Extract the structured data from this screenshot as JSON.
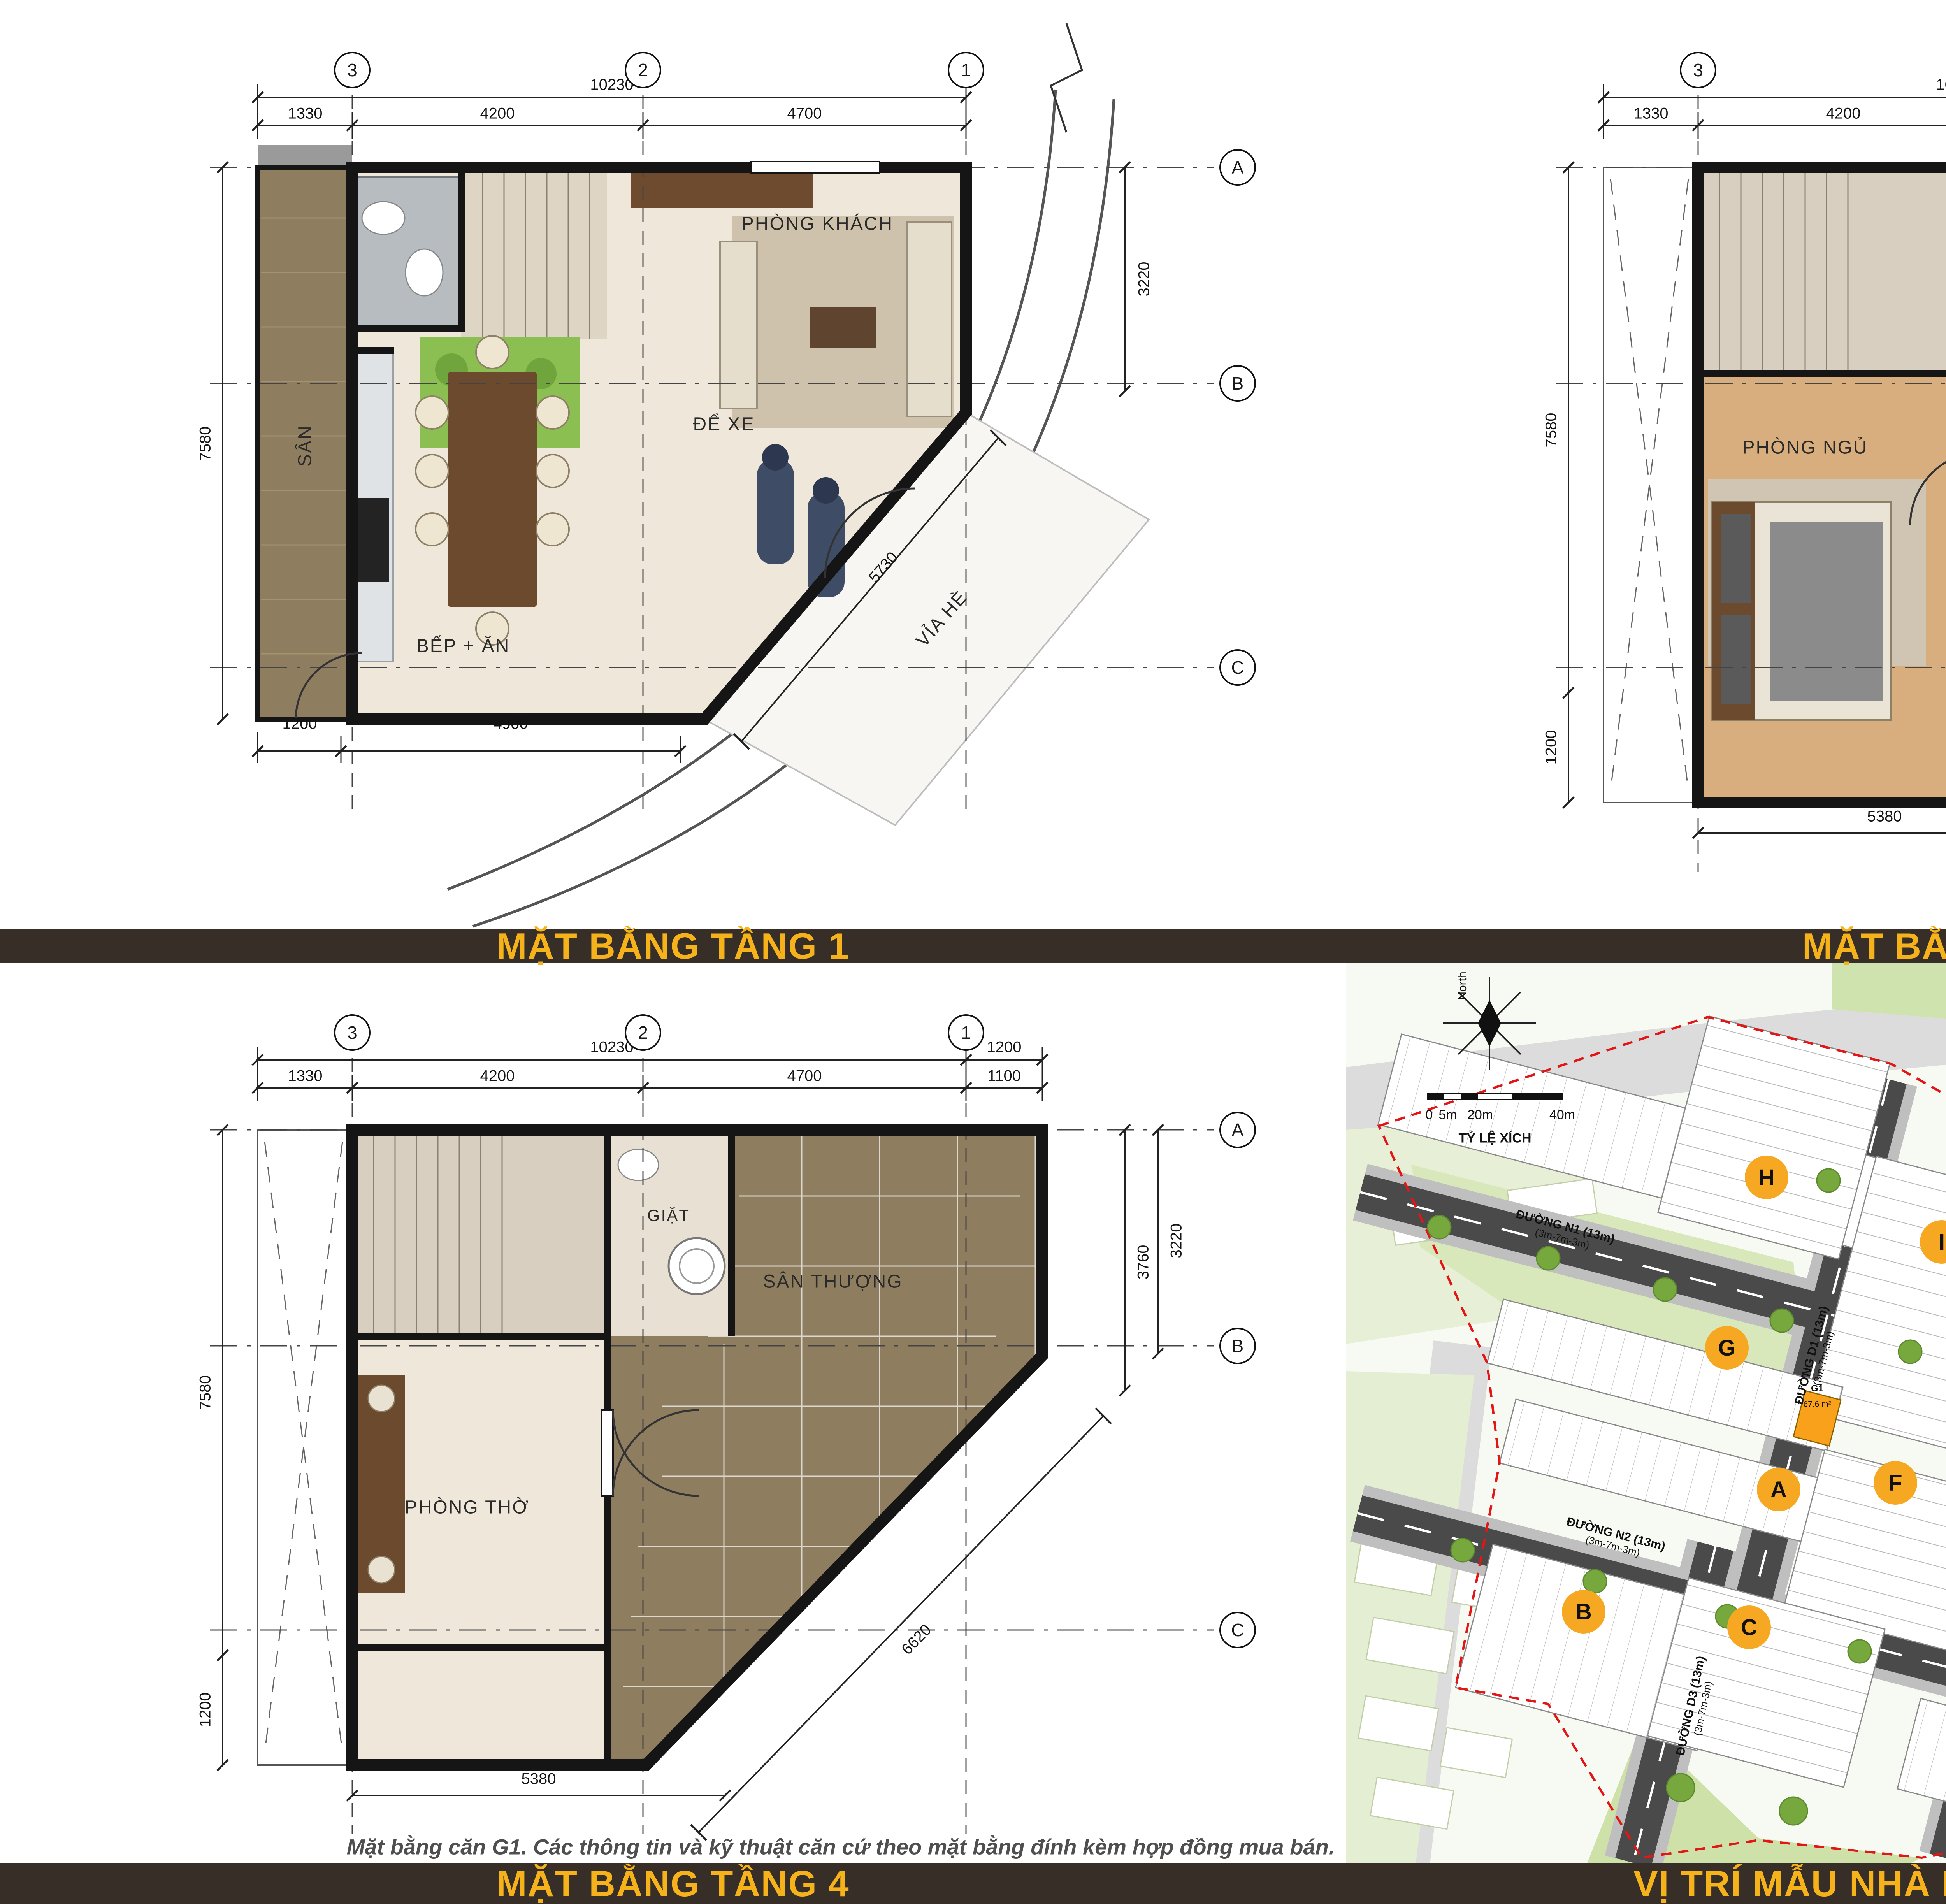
{
  "bars": {
    "floor1": "MẶT BẰNG TẦNG 1",
    "floor23": "MẶT BẰNG TẦNG 2 → 3",
    "floor4": "MẶT BẰNG TẦNG 4",
    "site": "VỊ TRÍ MẪU NHÀ MG2"
  },
  "caption": "Mặt bằng căn G1. Các thông tin và kỹ thuật căn cứ theo mặt bằng đính kèm hợp đồng mua bán.",
  "main_title": {
    "dark": "MẪU NHÀ",
    "accent": "MG2 (G1)"
  },
  "table": {
    "title": "BẢNG THỐNG KÊ CHI TIẾT MẪU NHÀ MG2",
    "headers": [
      {
        "l1": "Lô",
        "l2": ""
      },
      {
        "l1": "Kích thước nhà",
        "l2": "Rộng x Dài (m)"
      },
      {
        "l1": "Diện tích",
        "l2": "Khu đất (m²)"
      },
      {
        "l1": "Diện tích",
        "l2": "Sàn XD (m²)"
      }
    ],
    "row": [
      "G1",
      "10.23 x 7.58",
      "67.6",
      "237.6"
    ]
  },
  "floor1": {
    "grid_cols": [
      "3",
      "2",
      "1"
    ],
    "grid_rows": [
      "A",
      "B",
      "C"
    ],
    "dim_total": "10230",
    "dims_top": [
      "1330",
      "4200",
      "4700"
    ],
    "dim_left": "7580",
    "dim_right": "3220",
    "dims_bottom": [
      "1200",
      "4900"
    ],
    "dim_diag": "5730",
    "room_living": "PHÒNG KHÁCH",
    "room_kitchen": "BẾP + ĂN",
    "room_garage": "ĐỂ XE",
    "room_yard": "SÂN",
    "sidewalk": "VỈA HÈ"
  },
  "floor23": {
    "grid_cols": [
      "3",
      "2",
      "1"
    ],
    "grid_rows": [
      "A",
      "B",
      "C"
    ],
    "dim_total": "10230",
    "dim_top_right": "1200",
    "dims_top": [
      "1330",
      "4200",
      "4700",
      "1100"
    ],
    "dims_right": [
      "3760",
      "3220"
    ],
    "dim_left": "7580",
    "dim_left_bottom": "1200",
    "dim_bottom": "5380",
    "dim_diag": "6620",
    "room_bedroom": "PHÒNG NGỦ",
    "room_wc1": "WC",
    "room_wc2": "WC"
  },
  "floor4": {
    "grid_cols": [
      "3",
      "2",
      "1"
    ],
    "grid_rows": [
      "A",
      "B",
      "C"
    ],
    "dim_total": "10230",
    "dim_top_right": "1200",
    "dims_top": [
      "1330",
      "4200",
      "4700",
      "1100"
    ],
    "dims_right": [
      "3760",
      "3220"
    ],
    "dim_left": "7580",
    "dim_left_bottom": "1200",
    "dim_bottom": "5380",
    "dim_diag": "6620",
    "room_laundry": "GIẶT",
    "room_worship": "PHÒNG THỜ",
    "room_terrace": "SÂN THƯỢNG"
  },
  "site": {
    "north": "North",
    "scale_caption": "TỶ LỆ XÍCH",
    "scale_ticks": [
      "0",
      "5m",
      "20m",
      "40m"
    ],
    "roads": [
      {
        "name": "ĐƯỜNG N1 (13m)",
        "sub": "(3m-7m-3m)"
      },
      {
        "name": "ĐƯỜNG D1 (13m)",
        "sub": "(3m-7m-3m)"
      },
      {
        "name": "ĐƯỜNG N2 (13m)",
        "sub": "(3m-7m-3m)"
      },
      {
        "name": "ĐƯỜNG D2 (13m)",
        "sub": "(3m-7m-3m)"
      },
      {
        "name": "ĐƯỜNG N2 (13m)",
        "sub": "(3m-7m-3m)"
      },
      {
        "name": "ĐƯỜNG D3 (13m)",
        "sub": "(3m-7m-3m)"
      }
    ],
    "badges": [
      "H",
      "I",
      "K",
      "L",
      "G",
      "A",
      "F",
      "E",
      "B",
      "C",
      "D"
    ],
    "highlight": {
      "name": "G1",
      "area": "67.6 m²"
    }
  }
}
